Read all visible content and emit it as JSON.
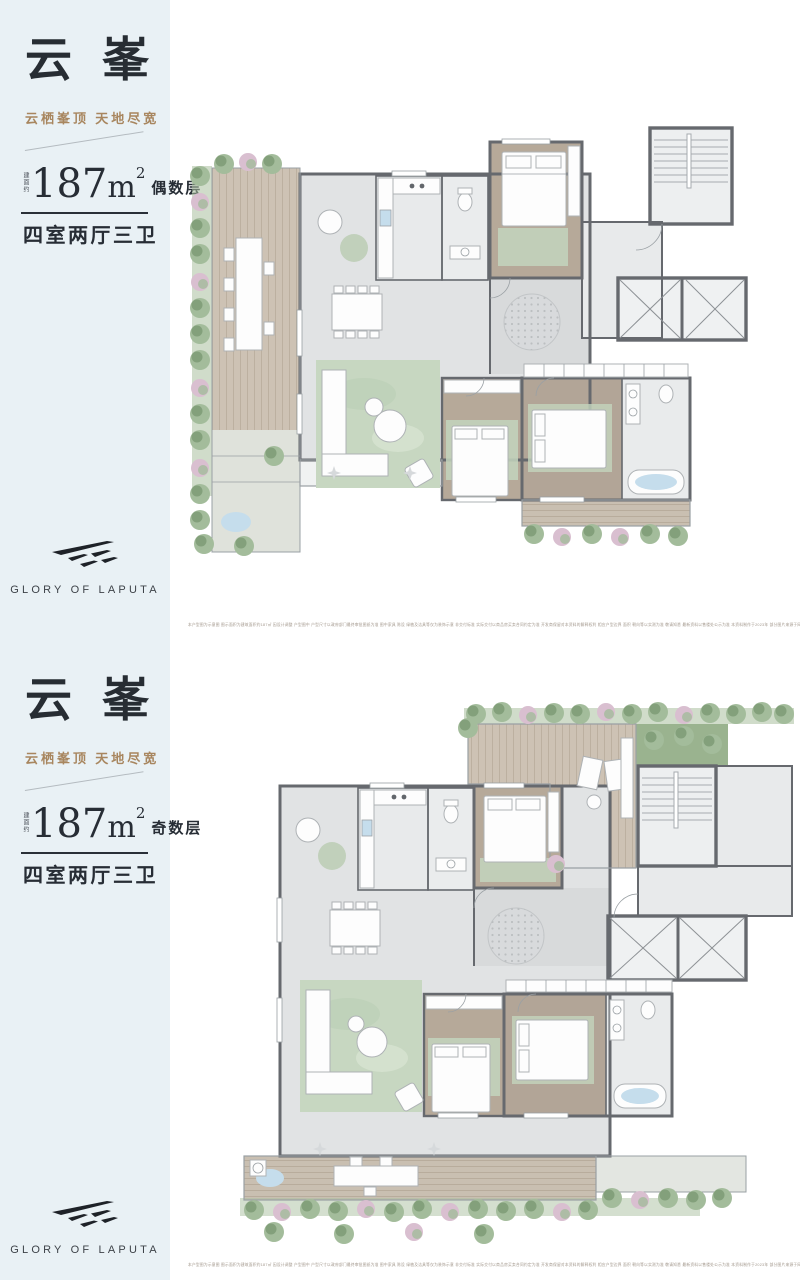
{
  "brand": {
    "logo_text": "GLORY OF LAPUTA",
    "logo_mark": "laputa-wing-icon"
  },
  "colors": {
    "sidebar_bg": "#e9f1f5",
    "title_color": "#272d33",
    "tagline_color": "#a8865f",
    "wall_color": "#66696e",
    "wood_deck": "#cdc2b4",
    "wood_room": "#b6a999",
    "plant_green": "#a3bc9b",
    "plant_dark": "#7f9c78",
    "plant_pink": "#d9bfd0",
    "rug_green": "#c7d7c1",
    "water_blue": "#c5ddec",
    "logo_color": "#1e2228"
  },
  "panels": [
    {
      "title": "云峯",
      "tagline": "云栖峯顶  天地尽宽",
      "area_prefix": "建面约",
      "area_number": "187",
      "area_unit": "m",
      "area_sup": "2",
      "floor_label": "偶数层",
      "layout_label": "四室两厅三卫",
      "disclaimer": "本户型图为示意图 图示面积为建筑面积约187㎡ 因设计调整 户型图中 户型尺寸以政府部门最终审批图纸为准 图中家具 陈设 绿植及洁具等仅为装饰示意 非交付标准 实际交付以商品房买卖合同约定为准 开发商保留对本资料的解释权利 相应户型边界 面积 朝向等以实测为准 敬请知悉 最新资料以售楼处公示为准 本资料制作于2023年 部分图片来源于网络 如有侵权请联系删除 敬请留意"
    },
    {
      "title": "云峯",
      "tagline": "云栖峯顶  天地尽宽",
      "area_prefix": "建面约",
      "area_number": "187",
      "area_unit": "m",
      "area_sup": "2",
      "floor_label": "奇数层",
      "layout_label": "四室两厅三卫",
      "disclaimer": "本户型图为示意图 图示面积为建筑面积约187㎡ 因设计调整 户型图中 户型尺寸以政府部门最终审批图纸为准 图中家具 陈设 绿植及洁具等仅为装饰示意 非交付标准 实际交付以商品房买卖合同约定为准 开发商保留对本资料的解释权利 相应户型边界 面积 朝向等以实测为准 敬请知悉 最新资料以售楼处公示为准 本资料制作于2023年 部分图片来源于网络 如有侵权请联系删除 敬请留意"
    }
  ]
}
